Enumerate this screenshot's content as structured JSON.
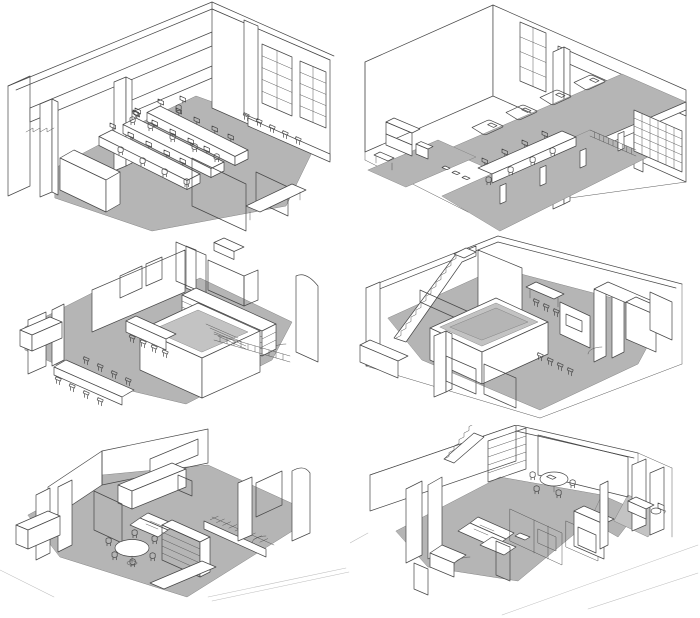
{
  "figure": {
    "kind": "architectural-axonometric-series",
    "grid": {
      "rows": 3,
      "columns": 2
    },
    "colors": {
      "background": "#ffffff",
      "floor_gray": "#b5b5b5",
      "line": "#474747",
      "wall_white": "#ffffff",
      "dark_screen": "#1a1a1a",
      "curtain_gray": "#bcbcbc",
      "curtain_hatch": "#8c8c8c"
    },
    "panels": [
      {
        "id": "top-left",
        "name": "open-office-level",
        "aria": "Axonometric cutaway of an open-plan office level: rows of desks with monitors and task chairs, overhead beams and columns, tall gridded windows on the right wall, bar stools and a grey hatched curtain screen"
      },
      {
        "id": "top-right",
        "name": "mezzanine-dormitory-level",
        "aria": "Axonometric cutaway of a double-height space: sleeping mezzanine slab with four mattresses above a row of work desks with monitors, lattice screen at right, back wall with tall gridded window"
      },
      {
        "id": "middle-left",
        "name": "kitchen-dining-level",
        "aria": "Axonometric cutaway of a kitchen and dining level: long dining table with stools, bar counter, central stair volume with slatted bridge, lattice shelving grids and long kitchen cabinet"
      },
      {
        "id": "middle-right",
        "name": "stair-landing-level",
        "aria": "Axonometric cutaway of a level with long staircase at left, sunken central box volume, hatched partition, lattice shelving, stools, small tables and partitioned rooms at right"
      },
      {
        "id": "bottom-left",
        "name": "living-dining-level",
        "aria": "Axonometric cutaway of a living-dining level: round table with six chairs, dark slatted wall screen, tall bookshelf, sofa, kitchen counters, hatched curtain wall and stair descending to the right"
      },
      {
        "id": "bottom-right",
        "name": "living-bedroom-level",
        "aria": "Axonometric cutaway of a living-bedroom level: sofa with round table and chairs, wall bookshelf, stair in the corner, hatched curtain partitions, wardrobes and a small bathroom at right"
      }
    ]
  }
}
